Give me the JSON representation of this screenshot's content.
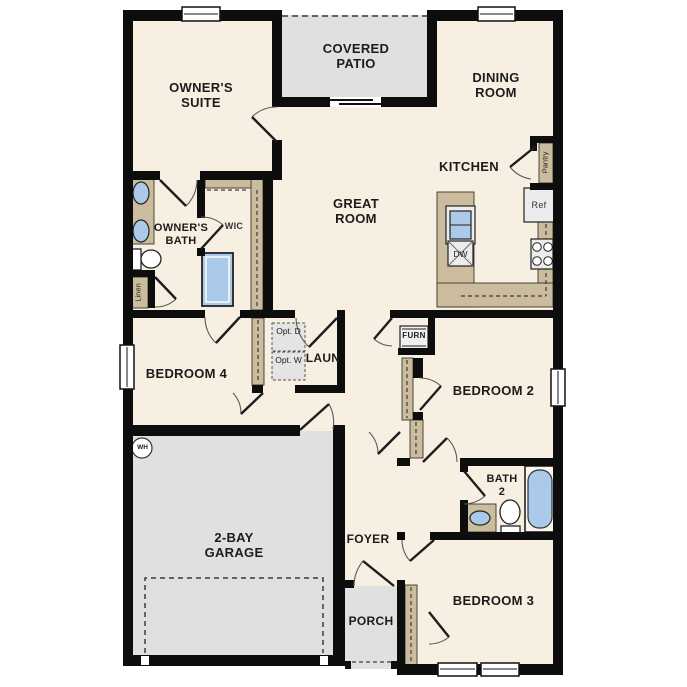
{
  "labels": {
    "covered_patio": "COVERED PATIO",
    "owners_suite": "OWNER'S SUITE",
    "dining_room": "DINING ROOM",
    "kitchen": "KITCHEN",
    "great_room": "GREAT ROOM",
    "owners_bath": "OWNER'S BATH",
    "wic": "WIC",
    "linen": "Linen",
    "pantry": "Pantry",
    "ref": "Ref",
    "dw": "DW",
    "laun": "LAUN",
    "opt_d": "Opt. D",
    "opt_w": "Opt. W",
    "furn": "FURN",
    "bedroom_4": "BEDROOM 4",
    "bedroom_2": "BEDROOM 2",
    "bedroom_3": "BEDROOM 3",
    "bath_2": "BATH 2",
    "wh": "WH",
    "garage": "2-BAY GARAGE",
    "foyer": "FOYER",
    "porch": "PORCH"
  },
  "colors": {
    "floor": "#f7efe2",
    "outdoor": "#e0e0e0",
    "cabinet": "#cbbc9e",
    "water": "#abc9e9",
    "wall": "#0d0d0d",
    "equipment": "#ececec"
  }
}
